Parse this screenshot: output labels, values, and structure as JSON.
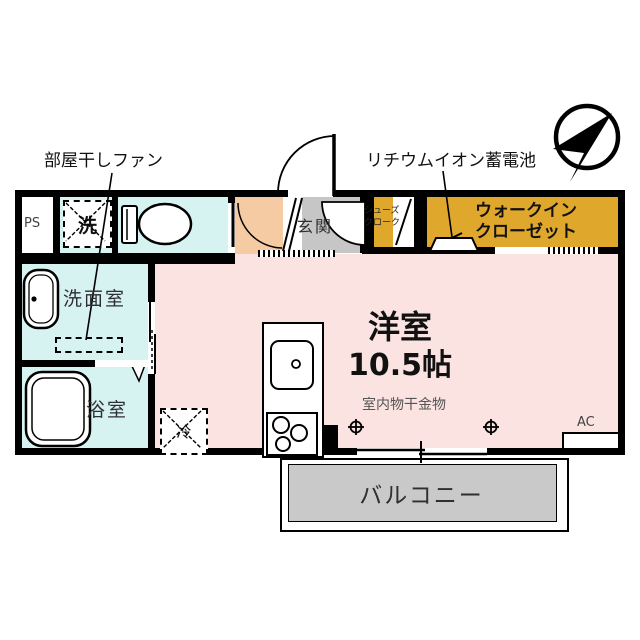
{
  "plan": {
    "labels": {
      "fan": "部屋干しファン",
      "battery": "リチウムイオン蓄電池",
      "wic1": "ウォークイン",
      "wic2": "クローゼット",
      "shoe1": "シューズ",
      "shoe2": "クローク",
      "entrance": "玄関",
      "ps": "PS",
      "washer": "洗",
      "washroom": "洗面室",
      "bathroom": "浴室",
      "room": "洋室",
      "room_size": "10.5帖",
      "hardware": "室内物干金物",
      "fridge": "冷",
      "ac": "AC",
      "balcony": "バルコニー"
    },
    "colors": {
      "water_rooms": "#D6F3F1",
      "main_room": "#FAE3E1",
      "closet": "#DFA72C",
      "hallway": "#F4CBA3",
      "entrance_floor": "#C6C6C6",
      "balcony_floor": "#C9C9C9",
      "wall": "#000000"
    }
  }
}
